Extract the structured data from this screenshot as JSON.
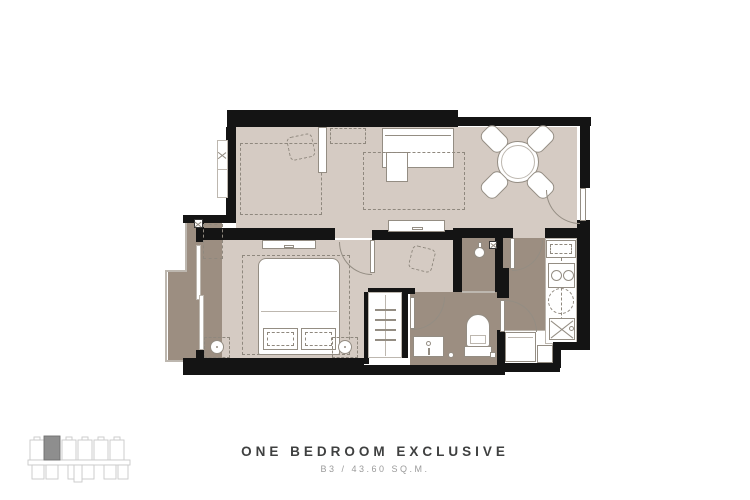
{
  "footer": {
    "title": "ONE BEDROOM EXCLUSIVE",
    "subtitle": "B3 / 43.60 SQ.M."
  },
  "colors": {
    "wall": "#141414",
    "floor_light": "#d5cbc3",
    "floor_dark": "#9c8e81",
    "outline": "#948d83",
    "outline_light": "#bdb7af",
    "dash": "#8f887e",
    "title_color": "#3f4040",
    "subtitle_color": "#9b9b9b",
    "keyplan_stroke": "#c9c9c9",
    "keyplan_fill": "#8e8e8e"
  },
  "icons": [
    "dining-table-icon",
    "dining-chair-icon",
    "sofa-icon",
    "rug-icon",
    "tv-console-icon",
    "double-bed-icon",
    "pillow-icon",
    "nightstand-icon",
    "table-lamp-icon",
    "wardrobe-hanger-icon",
    "desk-chair-icon",
    "toilet-icon",
    "vanity-sink-icon",
    "shower-head-icon",
    "stove-burner-icon",
    "kitchen-sink-icon",
    "washer-icon",
    "ac-unit-icon",
    "door-swing-icon",
    "window-icon",
    "balcony-railing-icon",
    "building-key-plan-icon"
  ]
}
